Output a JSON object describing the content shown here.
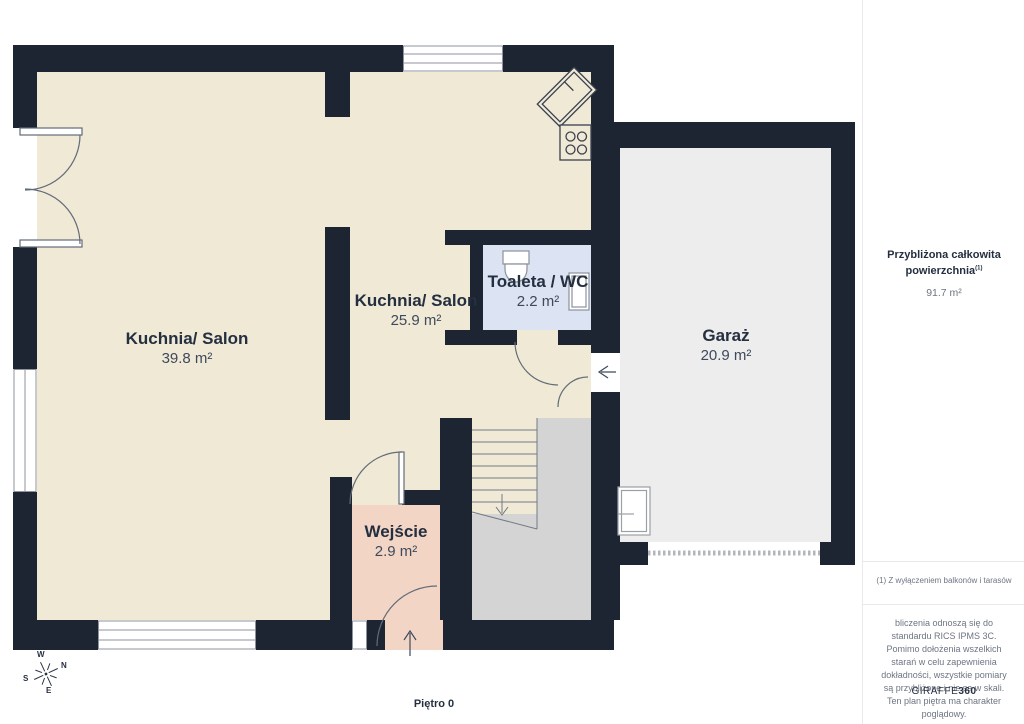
{
  "floor_label": "Piętro 0",
  "compass": {
    "n": "N",
    "s": "S",
    "e": "E",
    "w": "W"
  },
  "rooms": [
    {
      "name": "Kuchnia/ Salon",
      "area": "39.8 m²"
    },
    {
      "name": "Kuchnia/ Salon",
      "area": "25.9 m²"
    },
    {
      "name": "Toaleta / WC",
      "area": "2.2 m²"
    },
    {
      "name": "Garaż",
      "area": "20.9 m²"
    },
    {
      "name": "Wejście",
      "area": "2.9 m²"
    }
  ],
  "sidebar": {
    "total_area_label_line1": "Przybliżona całkowita",
    "total_area_label_line2": "powierzchnia",
    "total_area_footnote_marker": "(1)",
    "total_area_value": "91.7 m²",
    "footnote": "(1) Z wyłączeniem balkonów i tarasów",
    "disclaimer": "bliczenia odnoszą się do standardu RICS IPMS 3C. Pomimo dołożenia wszelkich starań w celu zapewnienia dokładności, wszystkie pomiary są przybliżone i nie są w skali. Ten plan piętra ma charakter poglądowy.",
    "brand_name": "GIRAFFE",
    "brand_suffix": "360"
  },
  "colors": {
    "wall": "#1d2533",
    "living_cream": "#f0e9d6",
    "entry_pink": "#f3d5c6",
    "toilet_blue": "#dce3f2",
    "garage_gray": "#ededed",
    "hall_gray": "#d4d4d4",
    "text_navy": "#242f40"
  }
}
